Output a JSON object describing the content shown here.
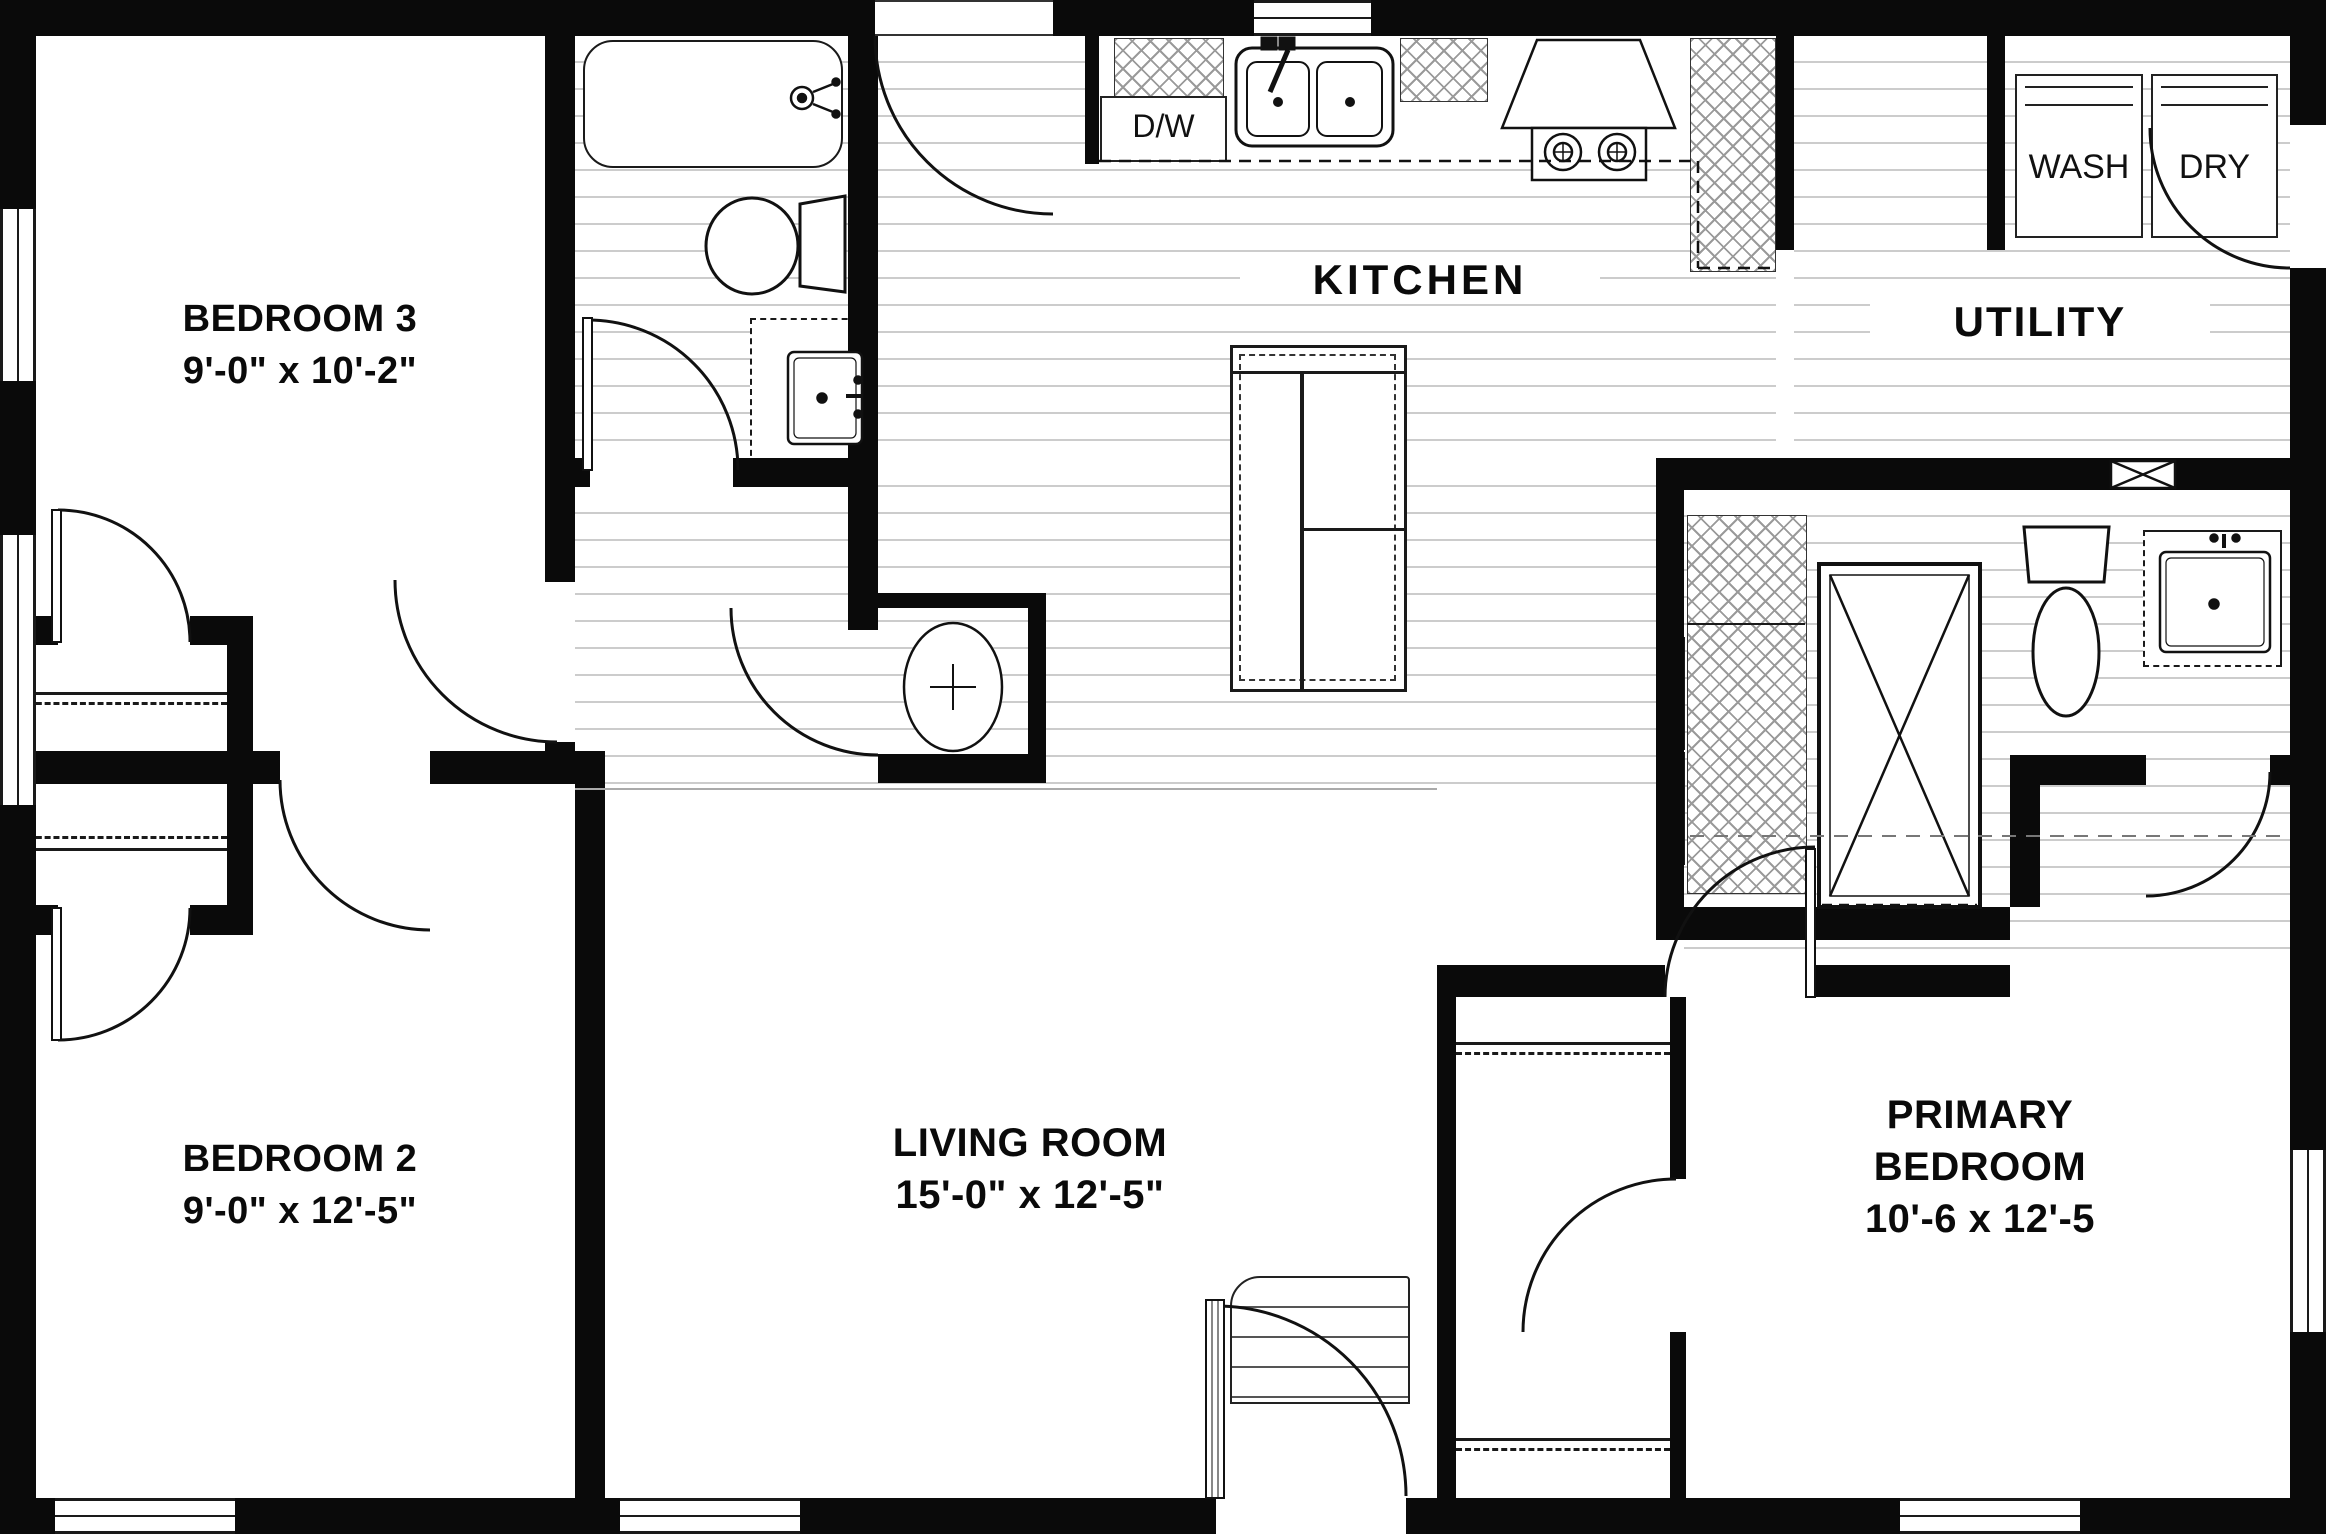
{
  "plan_title": "3-bedroom manufactured home floor plan",
  "rooms": {
    "bedroom3": {
      "label": "BEDROOM 3",
      "dims": "9'-0\" x 10'-2\""
    },
    "bedroom2": {
      "label": "BEDROOM 2",
      "dims": "9'-0\" x 12'-5\""
    },
    "living": {
      "label": "LIVING ROOM",
      "dims": "15'-0\" x 12'-5\""
    },
    "primary": {
      "line1": "PRIMARY",
      "line2": "BEDROOM",
      "dims": "10'-6 x 12'-5"
    },
    "kitchen": {
      "label": "KITCHEN"
    },
    "utility": {
      "label": "UTILITY"
    }
  },
  "appliances": {
    "dishwasher": "D/W",
    "washer": "WASH",
    "dryer": "DRY"
  },
  "colors": {
    "wall": "#0a0a0a",
    "floor_line": "#cccccc",
    "hatch": "#9a9a9a",
    "fixture_line": "#111111",
    "background": "#ffffff"
  }
}
